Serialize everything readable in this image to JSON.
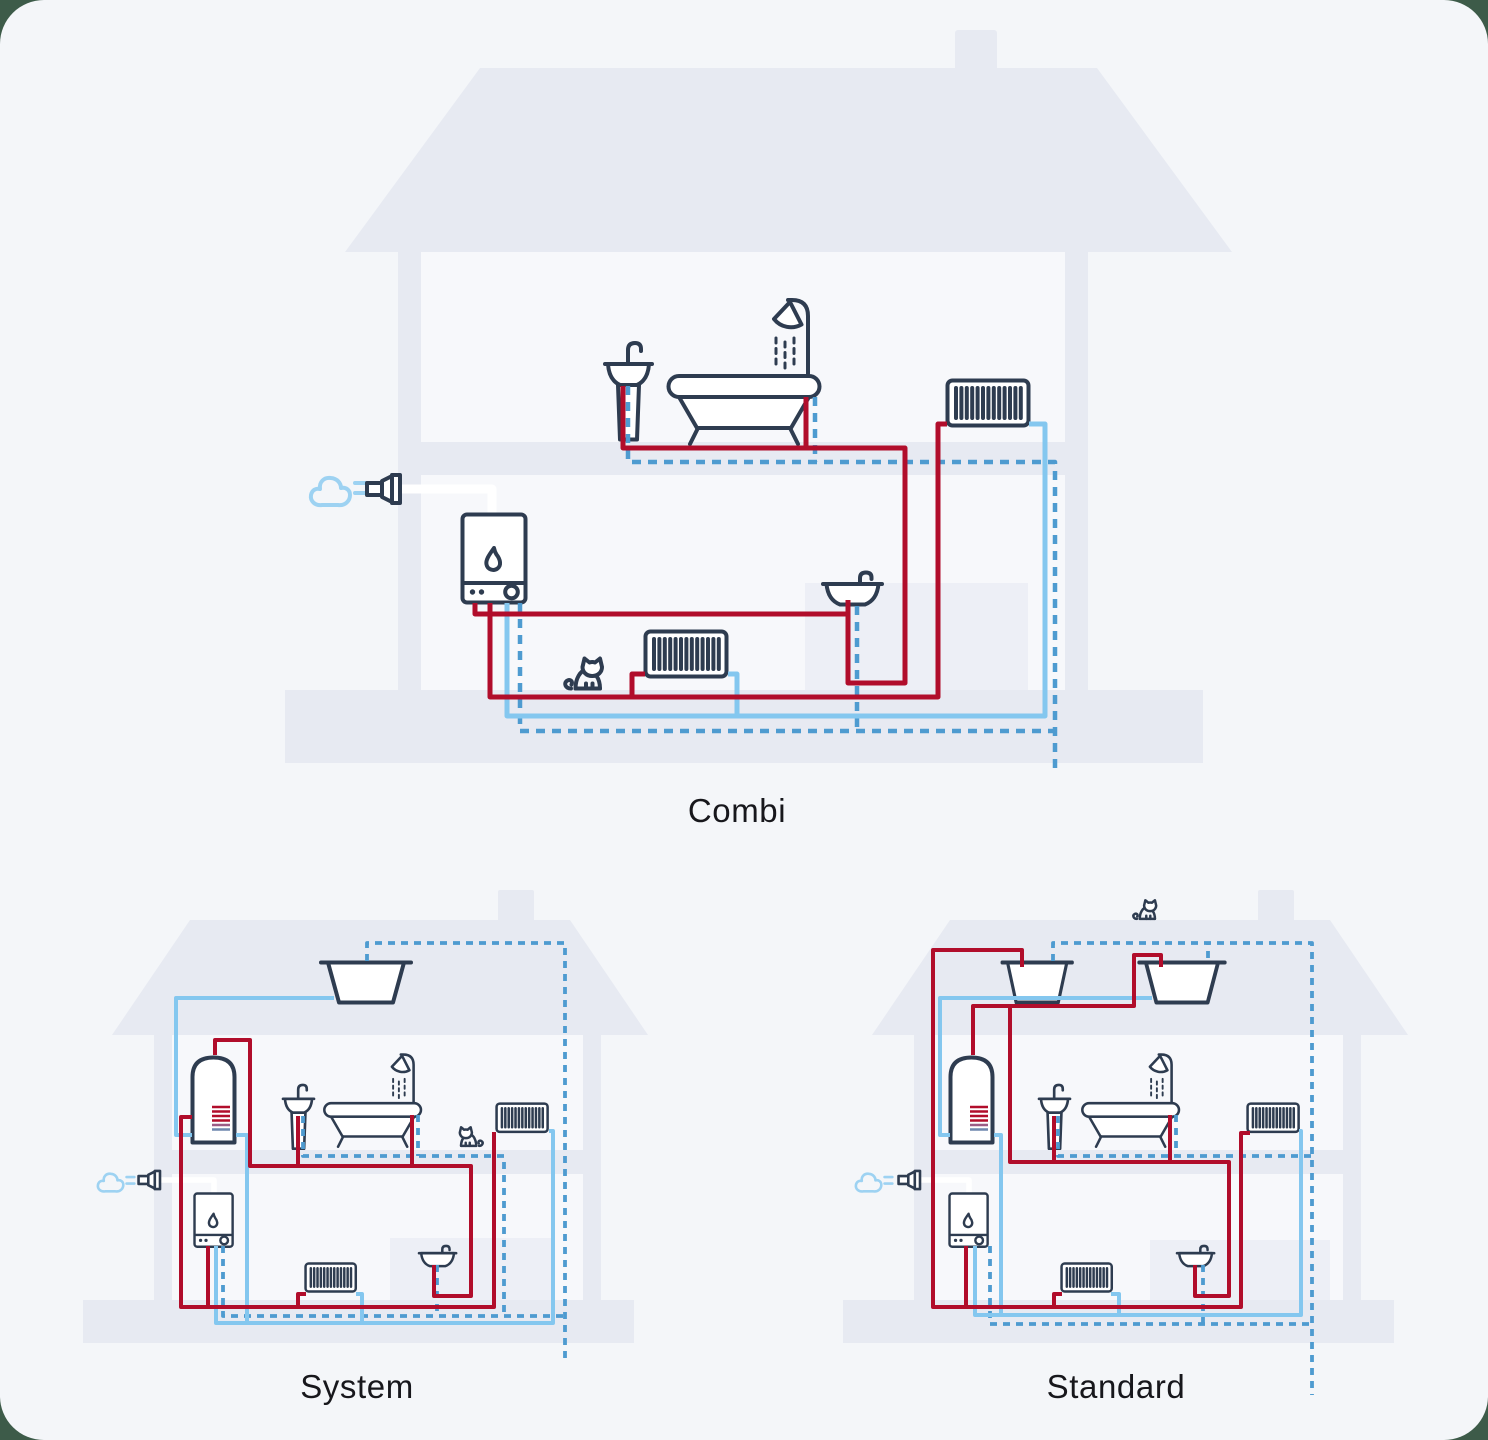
{
  "page": {
    "outer_background": "#3d5b49",
    "card_background": "#f4f6f9",
    "card_radius_px": 44
  },
  "colors": {
    "outer": "#3d5b49",
    "page": "#f4f6f9",
    "house": "#e7eaf2",
    "room": "#edeff6",
    "interior": "#f7f8fb",
    "navy": "#2e3c50",
    "red": "#b10d2b",
    "lblue": "#84c7ef",
    "mblue": "#4e9bd0",
    "steam": "#9dd2f2",
    "text": "#17171c"
  },
  "pipe_styles": [
    {
      "name": "solid-red",
      "color": "#b10d2b"
    },
    {
      "name": "solid-light-blue",
      "color": "#84c7ef"
    },
    {
      "name": "dashed-blue",
      "color": "#4e9bd0"
    }
  ],
  "diagrams": [
    {
      "id": "combi",
      "label": "Combi",
      "fixtures": [
        "steam-puff",
        "flue",
        "wall-boiler",
        "pedestal-sink",
        "bath-with-shower",
        "radiator-upstairs",
        "radiator-downstairs",
        "wall-basin",
        "cat"
      ]
    },
    {
      "id": "system",
      "label": "System",
      "fixtures": [
        "attic-cold-tank",
        "hot-water-cylinder",
        "steam-puff",
        "flue",
        "wall-boiler",
        "pedestal-sink",
        "bath-with-shower",
        "radiator-upstairs",
        "radiator-downstairs",
        "wall-basin",
        "cat"
      ]
    },
    {
      "id": "standard",
      "label": "Standard",
      "fixtures": [
        "cat-on-roof",
        "attic-feed-tank",
        "attic-cold-tank",
        "hot-water-cylinder",
        "steam-puff",
        "flue",
        "wall-boiler",
        "pedestal-sink",
        "bath-with-shower",
        "radiator-upstairs",
        "radiator-downstairs",
        "wall-basin"
      ]
    }
  ]
}
